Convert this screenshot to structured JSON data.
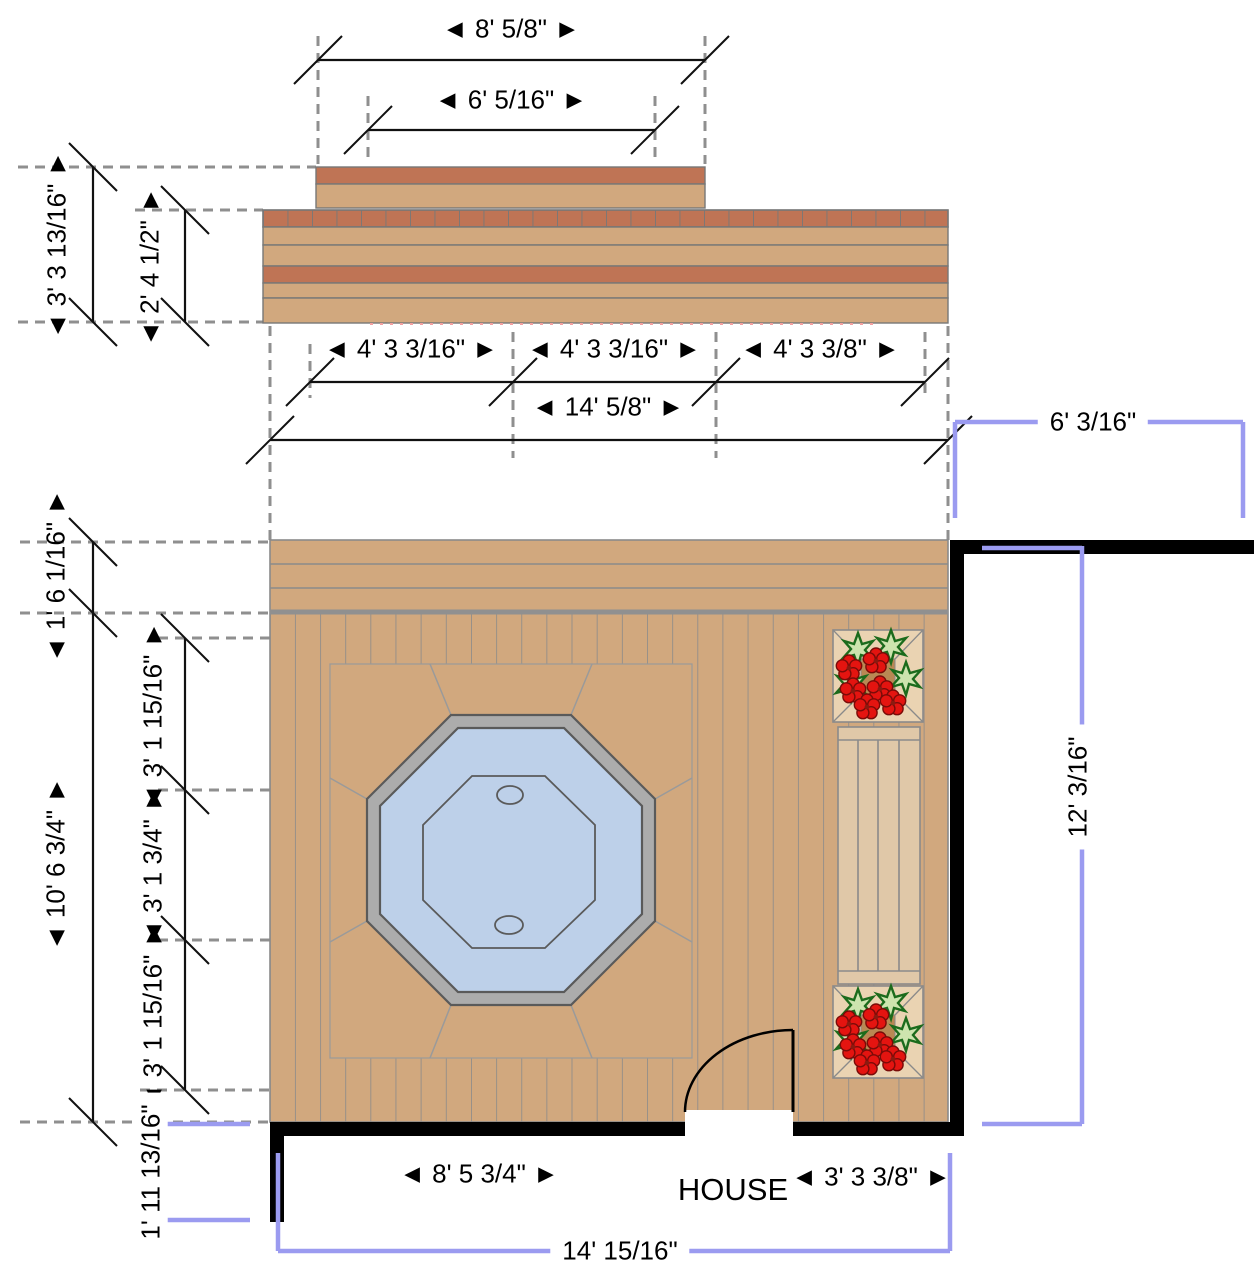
{
  "title": "Deck plan with hot tub, planters and bench beside house",
  "palette": {
    "deck_tan": "#D1A87E",
    "band_brown": "#BF7455",
    "bench_tan": "#E0C8A8",
    "planter_frame": "#EAD3B2",
    "planter_soil": "#B98853",
    "flower_red": "#E41410",
    "leaf_light": "#CDE4AE",
    "leaf_dark": "#1C6B1C",
    "water_blue": "#BDD0E9",
    "rim_gray": "#ACACAC",
    "dim_purple": "#9B9BF0",
    "dashed_gray": "#8F8F8F",
    "line_gray": "#8A8A8A",
    "wall_black": "#000000"
  },
  "dims": {
    "top_outer": {
      "label": "◄ 8' 5/8\" ►"
    },
    "top_inner": {
      "label": "◄ 6' 5/16\" ►"
    },
    "elev_left_outer": {
      "label": "◄ 3' 3 13/16\" ►"
    },
    "elev_left_inner": {
      "label": "◄ 2' 4 1/2\" ►"
    },
    "mid_seg1": {
      "label": "◄ 4' 3 3/16\" ►"
    },
    "mid_seg2": {
      "label": "◄ 4' 3 3/16\" ►"
    },
    "mid_seg3": {
      "label": "◄ 4' 3 3/8\" ►"
    },
    "mid_total": {
      "label": "◄ 14' 5/8\" ►"
    },
    "house_top_right": {
      "label": "6' 3/16\""
    },
    "house_right": {
      "label": "12' 3/16\""
    },
    "plan_left_small": {
      "label": "◄ 1' 6 1/16\" ►"
    },
    "plan_left_a": {
      "label": "◄ 3' 1 15/16\" ►"
    },
    "plan_left_b": {
      "label": "◄ 3' 1 3/4\" ►"
    },
    "plan_left_c": {
      "label": "◄ 3' 1 15/16\" ►"
    },
    "plan_left_outer": {
      "label": "◄ 10' 6 3/4\" ►"
    },
    "house_wall_left": {
      "label": "1' 11 13/16\""
    },
    "wall_bottom_left": {
      "label": "◄ 8' 5 3/4\" ►"
    },
    "wall_bottom_right": {
      "label": "◄ 3' 3 3/8\" ►"
    },
    "house_bottom": {
      "label": "14' 15/16\""
    }
  },
  "labels": {
    "house": "HOUSE"
  }
}
